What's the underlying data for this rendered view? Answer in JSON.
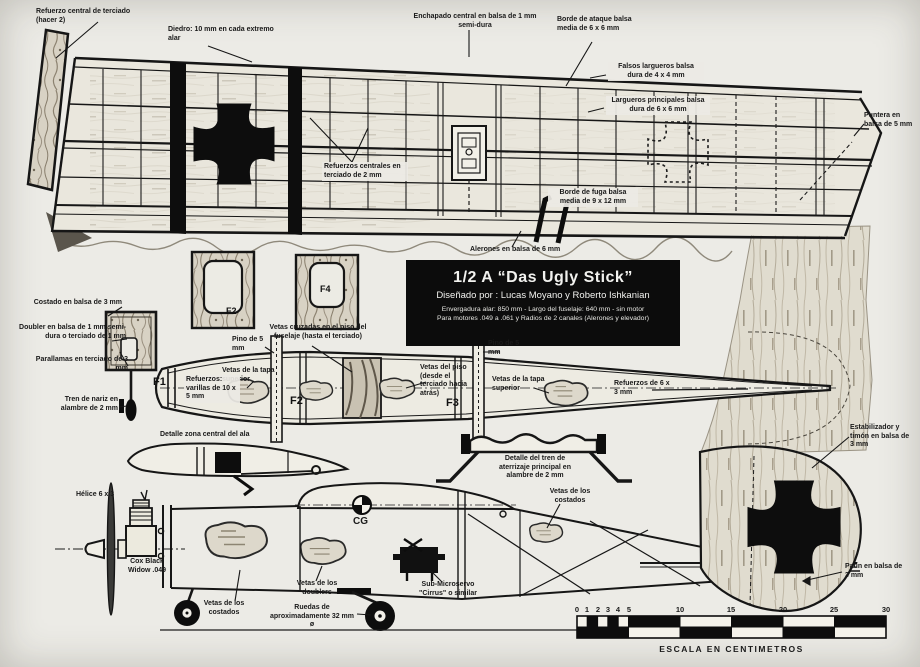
{
  "sheet": {
    "bg": "#ecebe6",
    "ink": "#1a1a1a",
    "accent_black": "#0c0c0c"
  },
  "insignias": {
    "wing": "iron-cross",
    "rudder": "iron-cross",
    "wing_right": "iron-cross-dashed-outline"
  },
  "title_box": {
    "line1": "1/2 A “Das Ugly Stick”",
    "line2": "Diseñado por : Lucas Moyano y Roberto Ishkanian",
    "line3": "Envergadura alar: 850 mm - Largo del fuselaje: 640 mm - sin motor",
    "line4": "Para motores .049 a .061 y Radios de 2 canales (Alerones y elevador)"
  },
  "labels": {
    "refuerzo_central": "Refuerzo central de terciado (hacer 2)",
    "diedro": "Diedro: 10 mm en cada extremo alar",
    "enchapado": "Enchapado central en balsa de 1 mm semi-dura",
    "borde_ataque": "Borde de ataque balsa media de 6 x 6 mm",
    "falsos_largueros": "Falsos largueros balsa dura de 4 x 4 mm",
    "largueros_principales": "Largueros principales balsa dura de 6 x 6 mm",
    "puntera": "Puntera en balsa de 5 mm",
    "refuerzos_centrales": "Refuerzos centrales en terciado de 2 mm",
    "borde_fuga": "Borde de fuga balsa media de 9 x 12 mm",
    "alerones": "Alerones en balsa de 6 mm",
    "costado": "Costado en balsa de 3 mm",
    "doubler": "Doubler en balsa de 1 mm semi-dura o terciado de 1 mm",
    "parallamas": "Parallamas en terciado de 3 mm",
    "tren_nariz": "Tren de nariz en alambre de 2 mm",
    "pino": "Pino de 5 mm",
    "vetas_cruzadas": "Vetas cruzadas en el piso del fuselaje (hasta el terciado)",
    "vetas_tapa_superior": "Vetas de la tapa superior",
    "refuerzos_varillas": "Refuerzos: varillas de 10 x 5 mm",
    "vetas_piso": "Vetas del piso (desde el terciado hacia atrás)",
    "refuerzos_6x3": "Refuerzos de 6 x 3 mm",
    "estabilizador": "Estabilizador y timón en balsa de 3 mm",
    "detalle_ala": "Detalle zona central del ala",
    "detalle_tren": "Detalle del tren de aterrizaje principal en alambre de 2 mm",
    "vetas_costados": "Vetas de los costados",
    "helice": "Hélice 6 x 3",
    "cox": "Cox Black Widow .049",
    "vetas_doublers": "Vetas de los doublers",
    "ruedas": "Ruedas de aproximadamente 32 mm ø",
    "sub_microservo": "Sub-Microservo \"Cirrus\" o similar",
    "patin": "Patín en balsa de 3 mm"
  },
  "formers": {
    "f1": "F1",
    "f2": "F2",
    "f3": "F3",
    "f4": "F4"
  },
  "cg": "CG",
  "scale_bar": {
    "ticks": [
      "0",
      "1",
      "2",
      "3",
      "4",
      "5",
      "10",
      "15",
      "20",
      "25",
      "30"
    ],
    "caption": "ESCALA EN CENTIMETROS"
  }
}
